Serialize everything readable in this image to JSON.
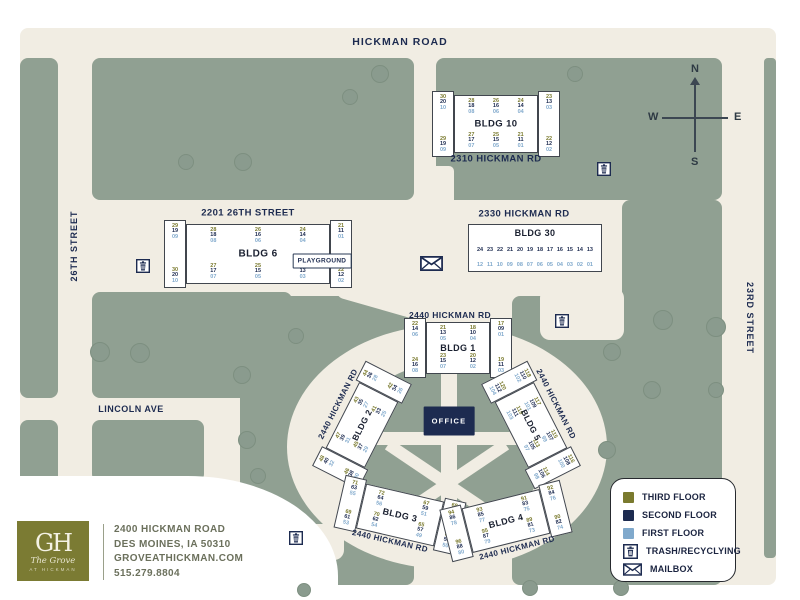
{
  "colors": {
    "sage": "#90a092",
    "cream": "#f1ede3",
    "navy": "#1d2b50",
    "olive": "#7a7a2e",
    "light_blue": "#80a9cc",
    "logo_olive": "#7b7b33"
  },
  "streets": {
    "hickman_road": "HICKMAN ROAD",
    "street_26th": "26TH STREET",
    "street_23rd": "23RD STREET",
    "lincoln_ave": "LINCOLN AVE"
  },
  "compass": {
    "n": "N",
    "e": "E",
    "s": "S",
    "w": "W"
  },
  "map_labels": [
    {
      "id": "label-2201-26th-street",
      "text": "2201 26TH STREET",
      "x": 248,
      "y": 213,
      "rot": 0,
      "size": 9.5
    },
    {
      "id": "label-2310-hickman-rd",
      "text": "2310 HICKMAN RD",
      "x": 496,
      "y": 159,
      "rot": 0,
      "size": 9.5
    },
    {
      "id": "label-2330-hickman-rd",
      "text": "2330 HICKMAN RD",
      "x": 524,
      "y": 214,
      "rot": 0,
      "size": 9.5
    },
    {
      "id": "label-2440-hickman-rd-bldg1",
      "text": "2440 HICKMAN RD",
      "x": 450,
      "y": 315,
      "rot": 0,
      "size": 8.5
    },
    {
      "id": "label-2440-hickman-rd-bldg2",
      "text": "2440 HICKMAN RD",
      "x": 338,
      "y": 404,
      "rot": -63,
      "size": 8
    },
    {
      "id": "label-2440-hickman-rd-bldg5",
      "text": "2440 HICKMAN RD",
      "x": 556,
      "y": 404,
      "rot": 63,
      "size": 8
    },
    {
      "id": "label-2440-hickman-rd-bldg3",
      "text": "2440 HICKMAN RD",
      "x": 390,
      "y": 541,
      "rot": 13,
      "size": 8
    },
    {
      "id": "label-2440-hickman-rd-bldg4",
      "text": "2440 HICKMAN RD",
      "x": 517,
      "y": 548,
      "rot": -14,
      "size": 8
    },
    {
      "id": "label-playground",
      "text": "PLAYGROUND",
      "x": 322,
      "y": 261,
      "rot": 0,
      "size": 6.5,
      "style": "boxed"
    },
    {
      "id": "label-office",
      "text": "OFFICE",
      "x": 449,
      "y": 421,
      "rot": 0,
      "size": 7.5,
      "style": "office-box"
    }
  ],
  "buildings": [
    {
      "id": "bldg-10",
      "label": "BLDG 10",
      "x": 432,
      "y": 95,
      "w": 128,
      "h": 58,
      "rot": 0,
      "type": "caps",
      "label_size": 9.5,
      "left_cap": [
        [
          "30",
          "20",
          "10"
        ],
        [
          "29",
          "19",
          "09"
        ]
      ],
      "mid_top": [
        [
          "28",
          "18",
          "08"
        ],
        [
          "26",
          "16",
          "06"
        ],
        [
          "24",
          "14",
          "04"
        ]
      ],
      "mid_bottom": [
        [
          "27",
          "17",
          "07"
        ],
        [
          "25",
          "15",
          "05"
        ],
        [
          "21",
          "11",
          "01"
        ]
      ],
      "right_cap": [
        [
          "23",
          "13",
          "03"
        ],
        [
          "22",
          "12",
          "02"
        ]
      ]
    },
    {
      "id": "bldg-6",
      "label": "BLDG 6",
      "x": 164,
      "y": 224,
      "w": 188,
      "h": 60,
      "rot": 0,
      "type": "caps",
      "label_size": 10,
      "left_cap": [
        [
          "29",
          "19",
          "09"
        ],
        [
          "30",
          "20",
          "10"
        ]
      ],
      "mid_top": [
        [
          "28",
          "18",
          "08"
        ],
        [
          "26",
          "16",
          "06"
        ],
        [
          "24",
          "14",
          "04"
        ]
      ],
      "mid_bottom": [
        [
          "27",
          "17",
          "07"
        ],
        [
          "25",
          "15",
          "05"
        ],
        [
          "23",
          "13",
          "03"
        ]
      ],
      "right_cap": [
        [
          "21",
          "11",
          "01"
        ],
        [
          "22",
          "12",
          "02"
        ]
      ]
    },
    {
      "id": "bldg-30",
      "label": "BLDG 30",
      "x": 468,
      "y": 224,
      "w": 134,
      "h": 48,
      "rot": 0,
      "type": "rows",
      "label_size": 9,
      "row_second": [
        "24",
        "23",
        "22",
        "21",
        "20",
        "19",
        "18",
        "17",
        "16",
        "15",
        "14",
        "13"
      ],
      "row_first": [
        "12",
        "11",
        "10",
        "09",
        "08",
        "07",
        "06",
        "05",
        "04",
        "03",
        "02",
        "01"
      ]
    },
    {
      "id": "bldg-1",
      "label": "BLDG 1",
      "x": 404,
      "y": 322,
      "w": 108,
      "h": 52,
      "rot": 0,
      "type": "caps",
      "label_size": 9,
      "left_cap": [
        [
          "22",
          "14",
          "06"
        ],
        [
          "24",
          "16",
          "08"
        ]
      ],
      "mid_top": [
        [
          "21",
          "13",
          "05"
        ],
        [
          "18",
          "10",
          "04"
        ]
      ],
      "mid_bottom": [
        [
          "23",
          "15",
          "07"
        ],
        [
          "20",
          "12",
          "02"
        ]
      ],
      "right_cap": [
        [
          "17",
          "09",
          "01"
        ],
        [
          "19",
          "11",
          "03"
        ]
      ]
    },
    {
      "id": "bldg-2",
      "label": "BLDG 2",
      "x": 303,
      "y": 403,
      "w": 118,
      "h": 44,
      "rot": -63,
      "type": "caps",
      "label_size": 8.5,
      "left_cap": [
        [
          "48",
          "40",
          "32"
        ],
        [
          "46",
          "38",
          "30"
        ]
      ],
      "mid_top": [
        [
          "47",
          "39",
          "31"
        ],
        [
          "43",
          "35",
          "27"
        ]
      ],
      "mid_bottom": [
        [
          "45",
          "37",
          "29"
        ],
        [
          "41",
          "33",
          "25"
        ]
      ],
      "right_cap": [
        [
          "44",
          "36",
          "28"
        ],
        [
          "42",
          "34",
          "26"
        ]
      ]
    },
    {
      "id": "bldg-5",
      "label": "BLDG 5",
      "x": 472,
      "y": 403,
      "w": 118,
      "h": 44,
      "rot": 63,
      "type": "caps",
      "label_size": 8.5,
      "left_cap": [
        [
          "118",
          "110",
          "102"
        ],
        [
          "120",
          "112",
          "104"
        ]
      ],
      "mid_top": [
        [
          "117",
          "109",
          "101"
        ],
        [
          "115",
          "107",
          "99"
        ]
      ],
      "mid_bottom": [
        [
          "119",
          "111",
          "103"
        ],
        [
          "113",
          "105",
          "97"
        ]
      ],
      "right_cap": [
        [
          "116",
          "108",
          "100"
        ],
        [
          "114",
          "106",
          "98"
        ]
      ]
    },
    {
      "id": "bldg-3",
      "label": "BLDG 3",
      "x": 338,
      "y": 492,
      "w": 124,
      "h": 46,
      "rot": 13,
      "type": "caps",
      "label_size": 9,
      "left_cap": [
        [
          "71",
          "63",
          "55"
        ],
        [
          "69",
          "61",
          "53"
        ]
      ],
      "mid_top": [
        [
          "72",
          "64",
          "56"
        ],
        [
          "67",
          "59",
          "51"
        ]
      ],
      "mid_bottom": [
        [
          "70",
          "62",
          "54"
        ],
        [
          "65",
          "57",
          "49"
        ]
      ],
      "right_cap": [
        [
          "68",
          "60",
          "52"
        ],
        [
          "66",
          "58",
          "50"
        ]
      ]
    },
    {
      "id": "bldg-4",
      "label": "BLDG 4",
      "x": 444,
      "y": 498,
      "w": 124,
      "h": 46,
      "rot": -14,
      "type": "caps",
      "label_size": 9,
      "left_cap": [
        [
          "94",
          "86",
          "78"
        ],
        [
          "96",
          "88",
          "80"
        ]
      ],
      "mid_top": [
        [
          "93",
          "85",
          "77"
        ],
        [
          "91",
          "83",
          "75"
        ]
      ],
      "mid_bottom": [
        [
          "95",
          "87",
          "79"
        ],
        [
          "89",
          "81",
          "73"
        ]
      ],
      "right_cap": [
        [
          "92",
          "84",
          "76"
        ],
        [
          "90",
          "82",
          "74"
        ]
      ]
    }
  ],
  "icons": [
    {
      "type": "trash",
      "x": 136,
      "y": 259
    },
    {
      "type": "trash",
      "x": 597,
      "y": 162
    },
    {
      "type": "trash",
      "x": 555,
      "y": 314
    },
    {
      "type": "trash",
      "x": 289,
      "y": 531
    },
    {
      "type": "mailbox",
      "x": 420,
      "y": 256
    }
  ],
  "trees": [
    [
      380,
      74,
      9
    ],
    [
      350,
      97,
      8
    ],
    [
      575,
      74,
      8
    ],
    [
      186,
      162,
      8
    ],
    [
      243,
      162,
      9
    ],
    [
      100,
      352,
      10
    ],
    [
      140,
      353,
      10
    ],
    [
      242,
      375,
      9
    ],
    [
      296,
      336,
      8
    ],
    [
      612,
      352,
      9
    ],
    [
      663,
      320,
      10
    ],
    [
      716,
      327,
      10
    ],
    [
      652,
      390,
      9
    ],
    [
      607,
      450,
      9
    ],
    [
      247,
      440,
      9
    ],
    [
      258,
      476,
      8
    ],
    [
      530,
      588,
      8
    ],
    [
      621,
      588,
      8
    ],
    [
      304,
      590,
      7
    ],
    [
      716,
      390,
      8
    ]
  ],
  "legend": {
    "items": [
      {
        "icon": "swatch",
        "color": "#7a7a2e",
        "label": "THIRD FLOOR"
      },
      {
        "icon": "swatch",
        "color": "#1d2b50",
        "label": "SECOND FLOOR"
      },
      {
        "icon": "swatch",
        "color": "#80a9cc",
        "label": "FIRST FLOOR"
      },
      {
        "icon": "trash",
        "label": "TRASH/RECYCLYING"
      },
      {
        "icon": "mailbox",
        "label": "MAILBOX"
      }
    ]
  },
  "footer": {
    "monogram": "GH",
    "brand_script": "The Grove",
    "brand_sub": "AT HICKMAN",
    "address_line1": "2400 HICKMAN ROAD",
    "address_line2": "DES MOINES, IA 50310",
    "address_line3": "GROVEATHICKMAN.COM",
    "address_line4": "515.279.8804"
  }
}
